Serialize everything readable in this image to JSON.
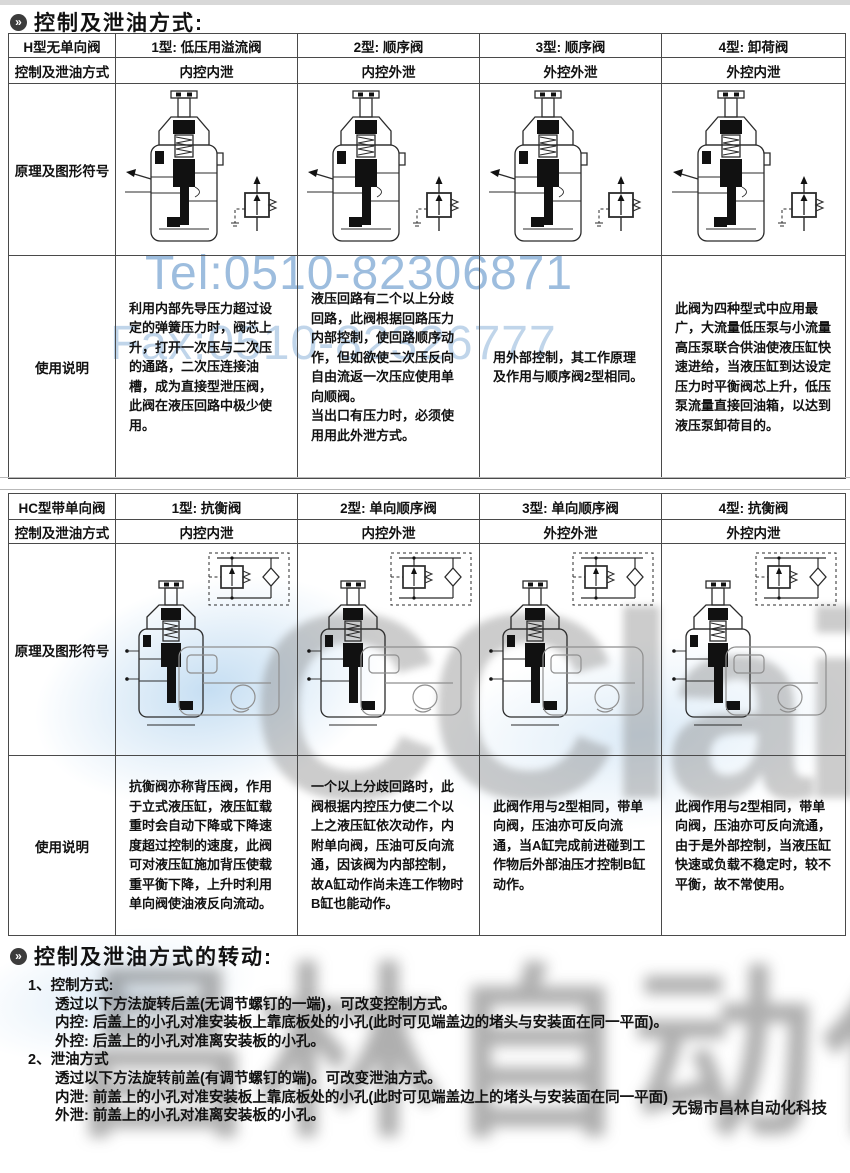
{
  "header": {
    "bullet": "»",
    "section1_title": "控制及泄油方式:",
    "section2_title": "控制及泄油方式的转动:"
  },
  "table_h": {
    "type_row": [
      "H型无单向阀",
      "1型: 低压用溢流阀",
      "2型: 顺序阀",
      "3型: 顺序阀",
      "4型: 卸荷阀"
    ],
    "control_row": [
      "控制及泄油方式",
      "内控内泄",
      "内控外泄",
      "外控外泄",
      "外控内泄"
    ],
    "diagram_label": "原理及图形符号",
    "usage_label": "使用说明",
    "usage": [
      "利用内部先导压力超过设定的弹簧压力时，阀芯上升，打开一次压与二次压的通路，二次压连接油槽，成为直接型泄压阀，此阀在液压回路中极少使用。",
      "液压回路有二个以上分歧回路，此阀根据回路压力内部控制，使回路顺序动作，但如欲使二次压反向自由流返一次压应使用单向顺阀。\n当出口有压力时，必须使用用此外泄方式。",
      "用外部控制，其工作原理及作用与顺序阀2型相同。",
      "此阀为四种型式中应用最广，大流量低压泵与小流量高压泵联合供油使液压缸快速进给，当液压缸到达设定压力时平衡阀芯上升，低压泵流量直接回油箱，以达到液压泵卸荷目的。"
    ]
  },
  "table_hc": {
    "type_row": [
      "HC型带单向阀",
      "1型: 抗衡阀",
      "2型: 单向顺序阀",
      "3型: 单向顺序阀",
      "4型: 抗衡阀"
    ],
    "control_row": [
      "控制及泄油方式",
      "内控内泄",
      "内控外泄",
      "外控外泄",
      "外控内泄"
    ],
    "diagram_label": "原理及图形符号",
    "usage_label": "使用说明",
    "usage": [
      "抗衡阀亦称背压阀，作用于立式液压缸，液压缸载重时会自动下降或下降速度超过控制的速度，此阀可对液压缸施加背压使载重平衡下降，上升时利用单向阀使油液反向流动。",
      "一个以上分歧回路时，此阀根据内控压力使二个以上之液压缸依次动作，内附单向阀，压油可反向流通，因该阀为内部控制，故A缸动作尚未连工作物时B缸也能动作。",
      "此阀作用与2型相同，带单向阀，压油亦可反向流通，当A缸完成前进碰到工作物后外部油压才控制B缸动作。",
      "此阀作用与2型相同，带单向阀，压油亦可反向流通，由于是外部控制，当液压缸快速或负载不稳定时，较不平衡，故不常使用。"
    ]
  },
  "notes": {
    "lines": [
      {
        "text": "1、控制方式:",
        "indent": 1
      },
      {
        "text": "透过以下方法旋转后盖(无调节螺钉的一端)，可改变控制方式。",
        "indent": 2
      },
      {
        "text": "内控: 后盖上的小孔对准安装板上靠底板处的小孔(此时可见端盖边的堵头与安装面在同一平面)。",
        "indent": 2
      },
      {
        "text": "外控: 后盖上的小孔对准离安装板的小孔。",
        "indent": 2
      },
      {
        "text": "2、泄油方式",
        "indent": 1
      },
      {
        "text": "透过以下方法旋转前盖(有调节螺钉的端)。可改变泄油方式。",
        "indent": 2
      },
      {
        "text": "内泄: 前盖上的小孔对准安装板上靠底板处的小孔(此时可见端盖边上的堵头与安装面在同一平面)",
        "indent": 2
      },
      {
        "text": "外泄: 前盖上的小孔对准离安装板的小孔。",
        "indent": 2
      }
    ]
  },
  "watermarks": {
    "tel": "Tel:0510-82306871",
    "fax": "Fax:0510-82326777",
    "logo": "CClair",
    "big_text": "昌林自动化",
    "blue": "#8cb2d8",
    "gray": "#585858"
  },
  "footer": {
    "company": "无锡市昌林自动化科技"
  }
}
